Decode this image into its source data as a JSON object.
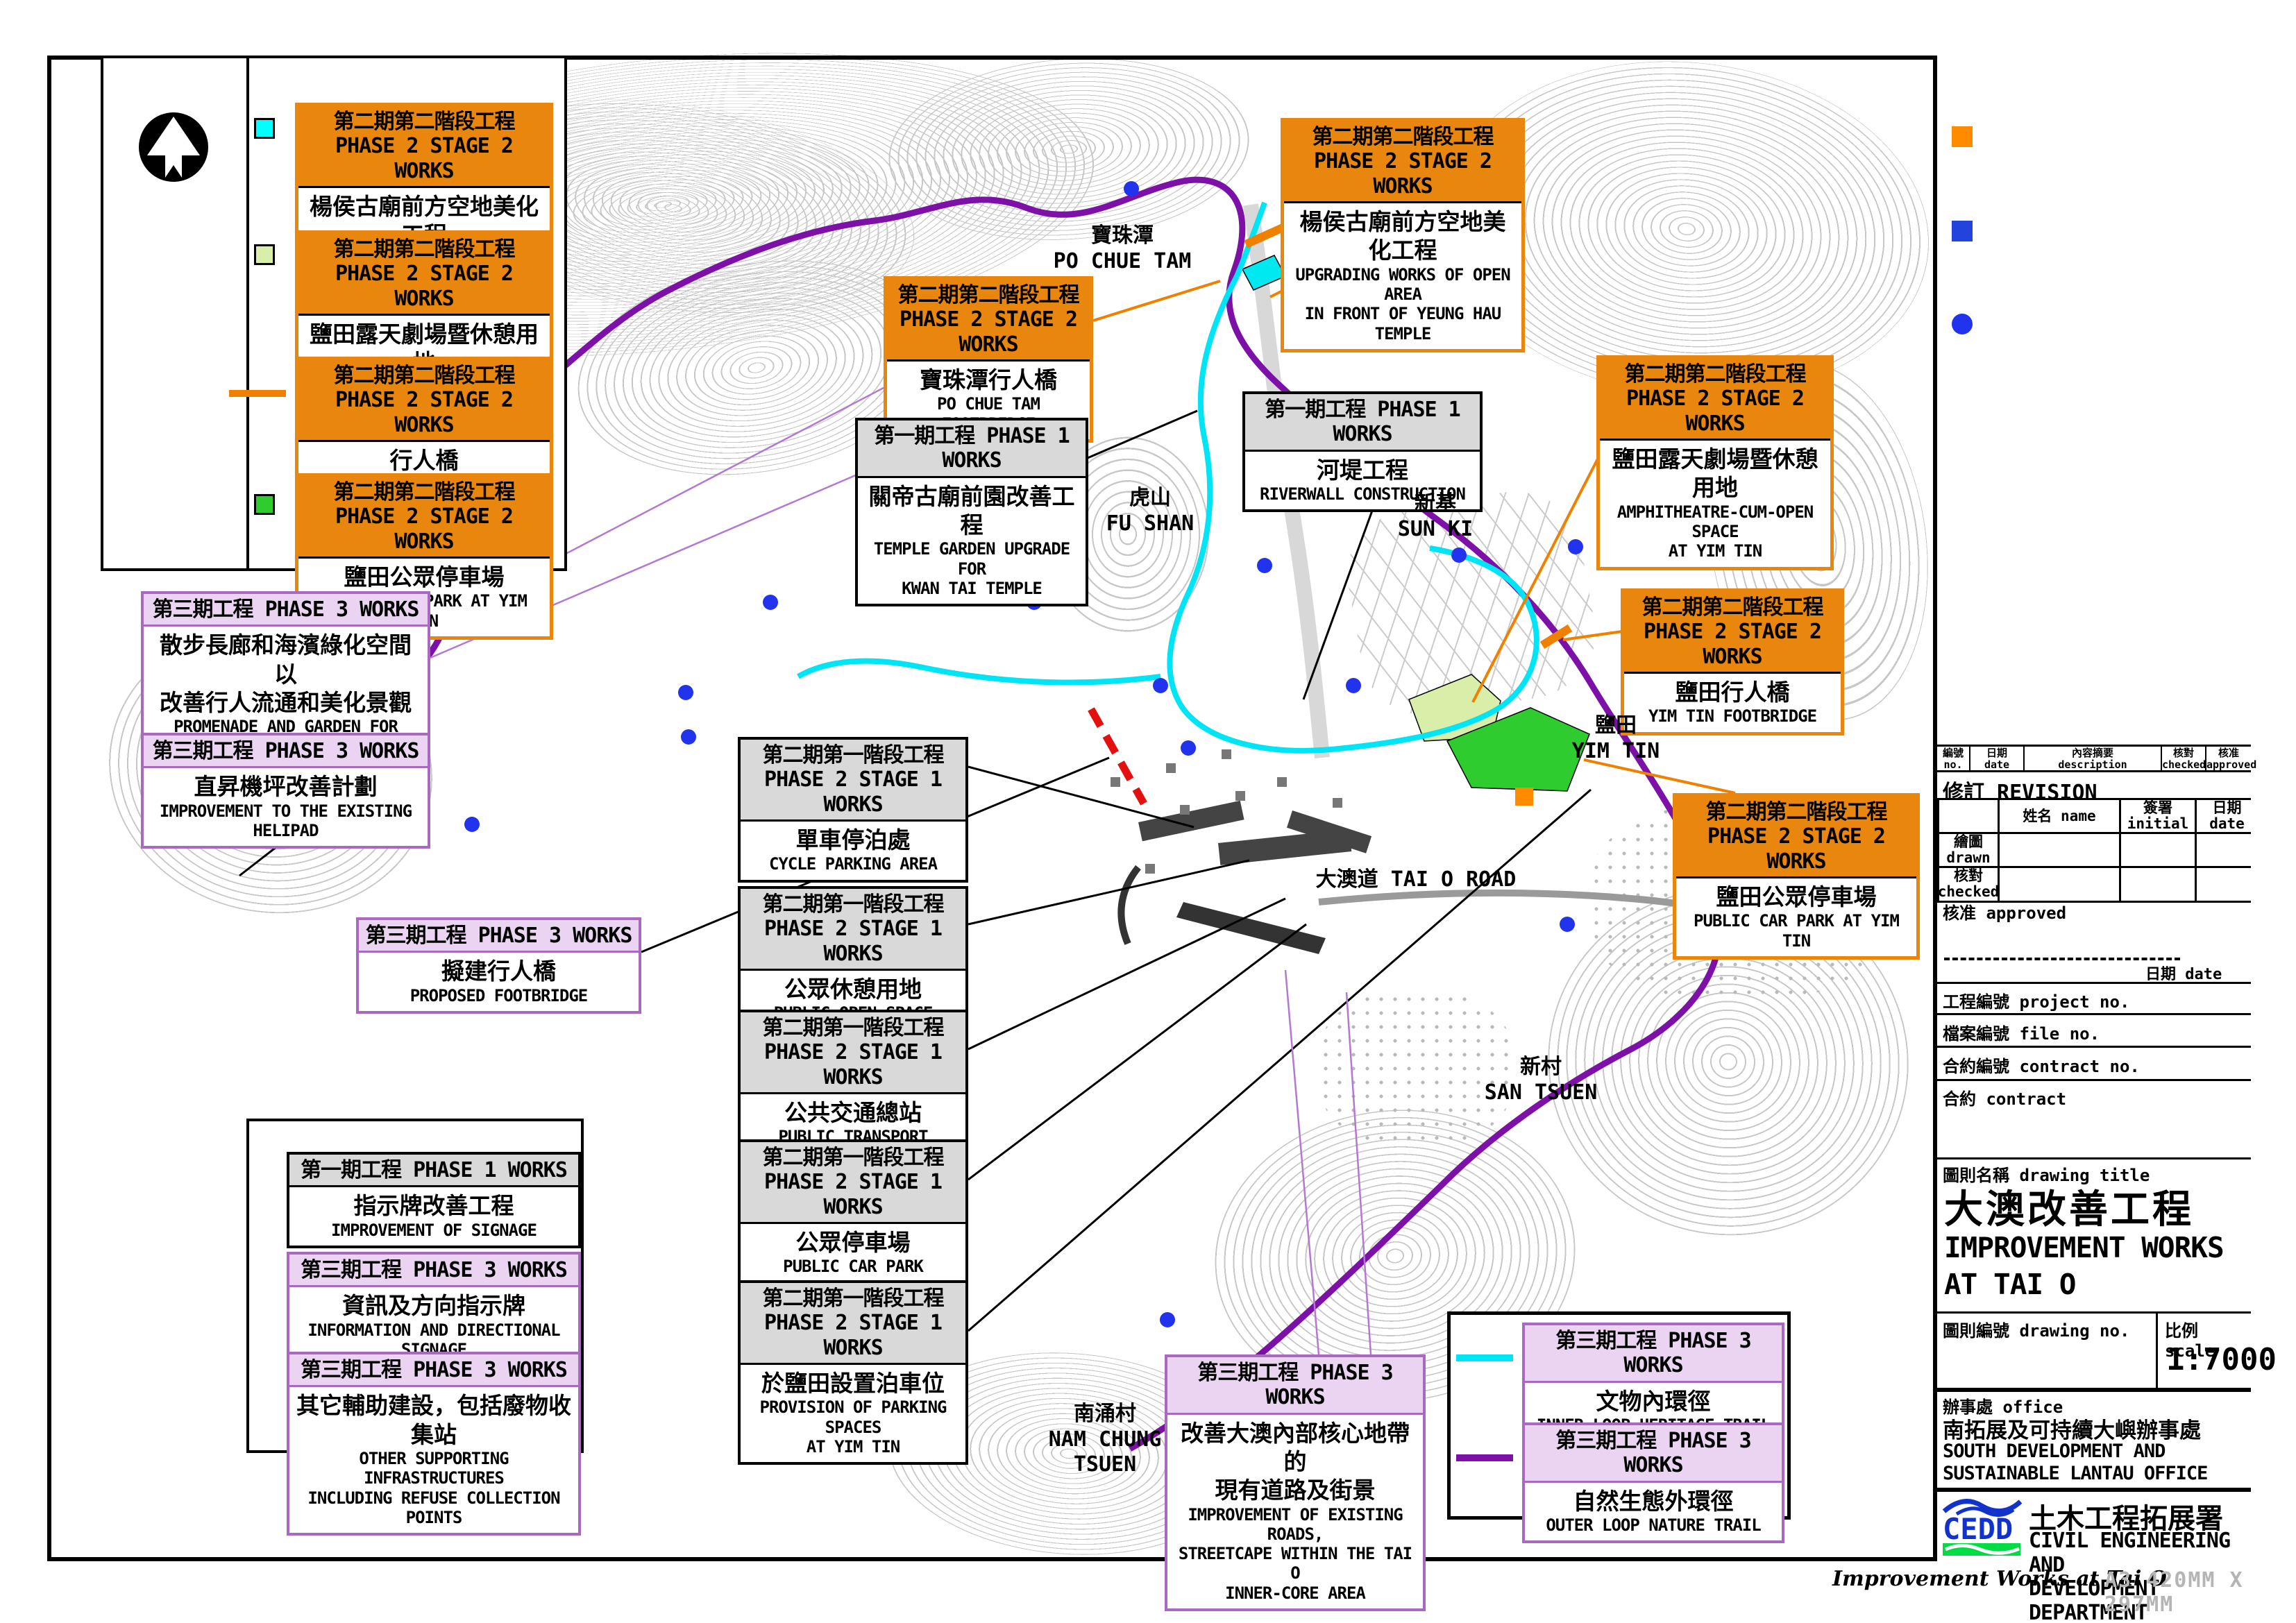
{
  "colors": {
    "accent_orange": "#E8860D",
    "accent_purple": "#A86ABE",
    "route_purple": "#7D10A6",
    "route_cyan": "#00E5F5",
    "swatch_cyan": "#00FFFF",
    "swatch_palegreen": "#D9EFA9",
    "swatch_green": "#2ECC2E",
    "refuse_orange": "#FF8C00",
    "refuse_blue": "#2244DD",
    "signage_blue": "#2233EE",
    "cedd_blue": "#1133CC",
    "cedd_green": "#00DD44",
    "proposed_red": "#E31010"
  },
  "boxes": {
    "b1": {
      "header": "第二期第二階段工程\nPHASE 2 STAGE 2 WORKS",
      "zh": "楊侯古廟前方空地美化工程",
      "en": "UPGRADING WORKS OF OPEN AREA\nIN FRONT OF YEUNG HAU TEMPLE"
    },
    "b2": {
      "header": "第二期第二階段工程\nPHASE 2 STAGE 2 WORKS",
      "zh": "鹽田露天劇場暨休憩用地",
      "en": "AMPHITHEATRE-CUM-OPEN SPACE\nAT YIM TIN"
    },
    "b3": {
      "header": "第二期第二階段工程\nPHASE 2 STAGE 2 WORKS",
      "zh": "行人橋",
      "en": "FOOTBRIDGES"
    },
    "b4": {
      "header": "第二期第二階段工程\nPHASE 2 STAGE 2 WORKS",
      "zh": "鹽田公眾停車場",
      "en": "PUBLIC CAR PARK AT YIM TIN"
    },
    "b5": {
      "header": "第三期工程  PHASE 3 WORKS",
      "zh": "散步長廊和海濱綠化空間以\n改善行人流通和美化景觀",
      "en": "PROMENADE AND GARDEN FOR\nIMPROVED CIRCULATION AND VIEWS"
    },
    "b6": {
      "header": "第三期工程  PHASE 3 WORKS",
      "zh": "直昇機坪改善計劃",
      "en": "IMPROVEMENT TO THE EXISTING\nHELIPAD"
    },
    "b7": {
      "header": "第三期工程  PHASE 3 WORKS",
      "zh": "擬建行人橋",
      "en": "PROPOSED FOOTBRIDGE"
    },
    "b8": {
      "header": "第一期工程  PHASE 1 WORKS",
      "zh": "指示牌改善工程",
      "en": "IMPROVEMENT OF SIGNAGE"
    },
    "b9": {
      "header": "第三期工程  PHASE 3 WORKS",
      "zh": "資訊及方向指示牌",
      "en": "INFORMATION AND DIRECTIONAL SIGNAGE"
    },
    "b10": {
      "header": "第三期工程  PHASE 3 WORKS",
      "zh": "其它輔助建設，包括廢物收集站",
      "en": "OTHER SUPPORTING INFRASTRUCTURES\nINCLUDING REFUSE COLLECTION POINTS"
    },
    "b11": {
      "header": "第二期第一階段工程\nPHASE 2 STAGE 1 WORKS",
      "zh": "單車停泊處",
      "en": "CYCLE PARKING AREA"
    },
    "b12": {
      "header": "第二期第一階段工程\nPHASE 2 STAGE 1 WORKS",
      "zh": "公眾休憩用地",
      "en": "PUBLIC OPEN SPACE"
    },
    "b13": {
      "header": "第二期第一階段工程\nPHASE 2 STAGE 1 WORKS",
      "zh": "公共交通總站",
      "en": "PUBLIC TRANSPORT TERMINUS"
    },
    "b14": {
      "header": "第二期第一階段工程\nPHASE 2 STAGE 1 WORKS",
      "zh": "公眾停車場",
      "en": "PUBLIC CAR PARK"
    },
    "b15": {
      "header": "第二期第一階段工程\nPHASE 2 STAGE 1 WORKS",
      "zh": "於鹽田設置泊車位",
      "en": "PROVISION OF PARKING SPACES\nAT YIM TIN"
    },
    "b16": {
      "header": "第二期第二階段工程\nPHASE 2 STAGE 2 WORKS",
      "zh": "寶珠潭行人橋",
      "en": "PO CHUE TAM FOOTBRIDGE"
    },
    "b17": {
      "header": "第一期工程  PHASE 1 WORKS",
      "zh": "關帝古廟前園改善工程",
      "en": "TEMPLE GARDEN UPGRADE FOR\nKWAN TAI TEMPLE"
    },
    "b18": {
      "header": "第一期工程  PHASE 1 WORKS",
      "zh": "河堤工程",
      "en": "RIVERWALL CONSTRUCTION"
    },
    "b19": {
      "header": "第二期第二階段工程\nPHASE 2 STAGE 2 WORKS",
      "zh": "楊侯古廟前方空地美化工程",
      "en": "UPGRADING WORKS OF OPEN AREA\nIN FRONT OF YEUNG HAU TEMPLE"
    },
    "b20": {
      "header": "第二期第二階段工程\nPHASE 2 STAGE 2 WORKS",
      "zh": "鹽田露天劇場暨休憩用地",
      "en": "AMPHITHEATRE-CUM-OPEN SPACE\nAT YIM TIN"
    },
    "b21": {
      "header": "第二期第二階段工程\nPHASE 2 STAGE 2 WORKS",
      "zh": "鹽田行人橋",
      "en": "YIM TIN FOOTBRIDGE"
    },
    "b22": {
      "header": "第二期第二階段工程\nPHASE 2 STAGE 2 WORKS",
      "zh": "鹽田公眾停車場",
      "en": "PUBLIC CAR PARK AT YIM TIN"
    },
    "b23": {
      "header": "第三期工程  PHASE 3 WORKS",
      "zh": "改善大澳內部核心地帶的\n現有道路及街景",
      "en": "IMPROVEMENT OF EXISTING ROADS,\nSTREETCAPE WITHIN THE TAI O\nINNER-CORE AREA"
    },
    "b24": {
      "header": "第三期工程  PHASE 3 WORKS",
      "zh": "文物內環徑",
      "en": "INNER LOOP HERITAGE TRAIL"
    },
    "b25": {
      "header": "第三期工程  PHASE 3 WORKS",
      "zh": "自然生態外環徑",
      "en": "OUTER LOOP NATURE TRAIL"
    }
  },
  "legend": {
    "title": "圖例 LEGEND :",
    "item1_zh": "廢物收集站",
    "item1_en": "REFUSE COLLECTION POINT\n(UNDER PHASE 2 STAGE 2)",
    "item2_zh": "廢物收集站",
    "item2_en": "REFUSE COLLECTION POINT\n(UNDER PHASE 3)",
    "item3_zh": "資訊及方向指示牌",
    "item3_en": "INFORMATION AND\nDIRECTIONAL SIGNAGE"
  },
  "map_labels": {
    "po_chue_tam": "寶珠潭\nPO CHUE TAM",
    "fu_shan": "虎山\nFU SHAN",
    "sun_ki": "新基\nSUN KI",
    "yim_tin": "鹽田\nYIM TIN",
    "tai_o_road": "大澳道 TAI O ROAD",
    "san_tsuen": "新村\nSAN TSUEN",
    "nam_chung_tsuen": "南涌村\nNAM CHUNG\nTSUEN"
  },
  "title_block": {
    "rev_cols": [
      "編號\nno.",
      "日期\ndate",
      "內容摘要\ndescription",
      "核對\nchecked",
      "核准\napproved"
    ],
    "revision": "修訂 REVISION",
    "sig_cols": [
      "姓名 name",
      "簽署 initial",
      "日期 date"
    ],
    "sig_row1": "繪圖\ndrawn",
    "sig_row2": "核對\nchecked",
    "approved": "核准 approved",
    "approved_date": "日期 date",
    "project": "工程編號 project no.",
    "file": "檔案編號 file no.",
    "contract_no": "合約編號 contract no.",
    "contract": "合約 contract",
    "dt_label": "圖則名稱 drawing title",
    "title_zh": "大澳改善工程",
    "title_en": "IMPROVEMENT WORKS\nAT TAI O",
    "dno_label": "圖則編號 drawing no.",
    "scale_label": "比例 scale",
    "scale_value": "1:7000",
    "office_label": "辦事處 office",
    "office_zh": "南拓展及可持續大嶼辦事處",
    "office_en": "SOUTH DEVELOPMENT AND\nSUSTAINABLE LANTAU OFFICE",
    "dept_logo": "CEDD",
    "dept_zh": "土木工程拓展署",
    "dept_en": "CIVIL ENGINEERING AND\nDEVELOPMENT DEPARTMENT"
  },
  "footer": {
    "left": "Improvement Works at Tai O",
    "right": "A3 420MM X 297MM"
  }
}
